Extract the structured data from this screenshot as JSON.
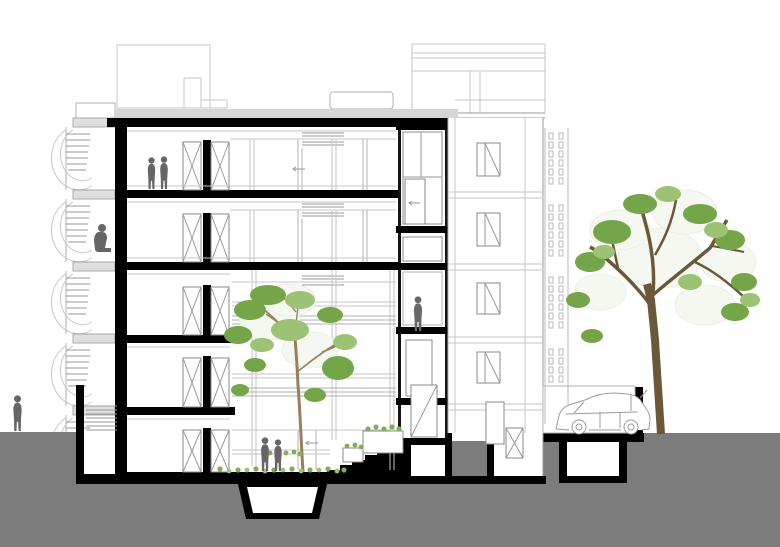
{
  "meta": {
    "title": "Residential building cross-section drawing",
    "drawing_type": "architectural section / elevation",
    "orientation": "street - building - courtyard - street"
  },
  "colors": {
    "paper": "#ffffff",
    "ink": "#000000",
    "earth": "#7c7c7c",
    "figure": "#666666",
    "slab_light": "#d6d6d6",
    "line_light": "#c6c6c6",
    "line_mid": "#9a9a9a",
    "foliage": "#74a549",
    "foliage_light": "#9cc274",
    "foliage_pale": "#e9f1e0",
    "trunk_dark": "#6b5839",
    "trunk_light": "#97805a",
    "grass": "#7fae57",
    "car_line": "#9b9b9b"
  },
  "scene": {
    "building": {
      "floors_above_ground": 5,
      "has_basement": true,
      "cut_elements": [
        "exterior wall",
        "floor slabs",
        "roof slab",
        "courtyard ground slab",
        "basement rooms"
      ],
      "features": [
        "spiral escape stair with landings",
        "interior courtyard with tree",
        "split-level shaft",
        "perforated screen wall",
        "outdoor steps to street",
        "parking bay with car"
      ]
    },
    "people": [
      {
        "id": "pedestrian-street-left",
        "pose": "standing",
        "location": "left sidewalk"
      },
      {
        "id": "couple-upper-floor",
        "pose": "standing pair",
        "location": "top floor room"
      },
      {
        "id": "resident-sitting",
        "pose": "sitting",
        "location": "spiral stair landing"
      },
      {
        "id": "resident-shaft",
        "pose": "standing",
        "location": "mid-level shaft room"
      },
      {
        "id": "couple-courtyard",
        "pose": "standing pair",
        "location": "ground floor courtyard"
      }
    ],
    "trees": [
      {
        "id": "courtyard-tree",
        "location": "interior courtyard",
        "foliage": "green with pale outline leaves"
      },
      {
        "id": "street-tree",
        "location": "right of building",
        "foliage": "green with pale outline leaves"
      }
    ],
    "vehicle": {
      "id": "car",
      "type": "hatchback, facing left",
      "location": "parking bay right of building"
    },
    "stairs": {
      "exterior_steps": 7,
      "location": "courtyard up to right street level"
    },
    "ground": {
      "type": "sectioned earth",
      "levels": [
        "left street",
        "sunken courtyard",
        "right street"
      ]
    }
  }
}
